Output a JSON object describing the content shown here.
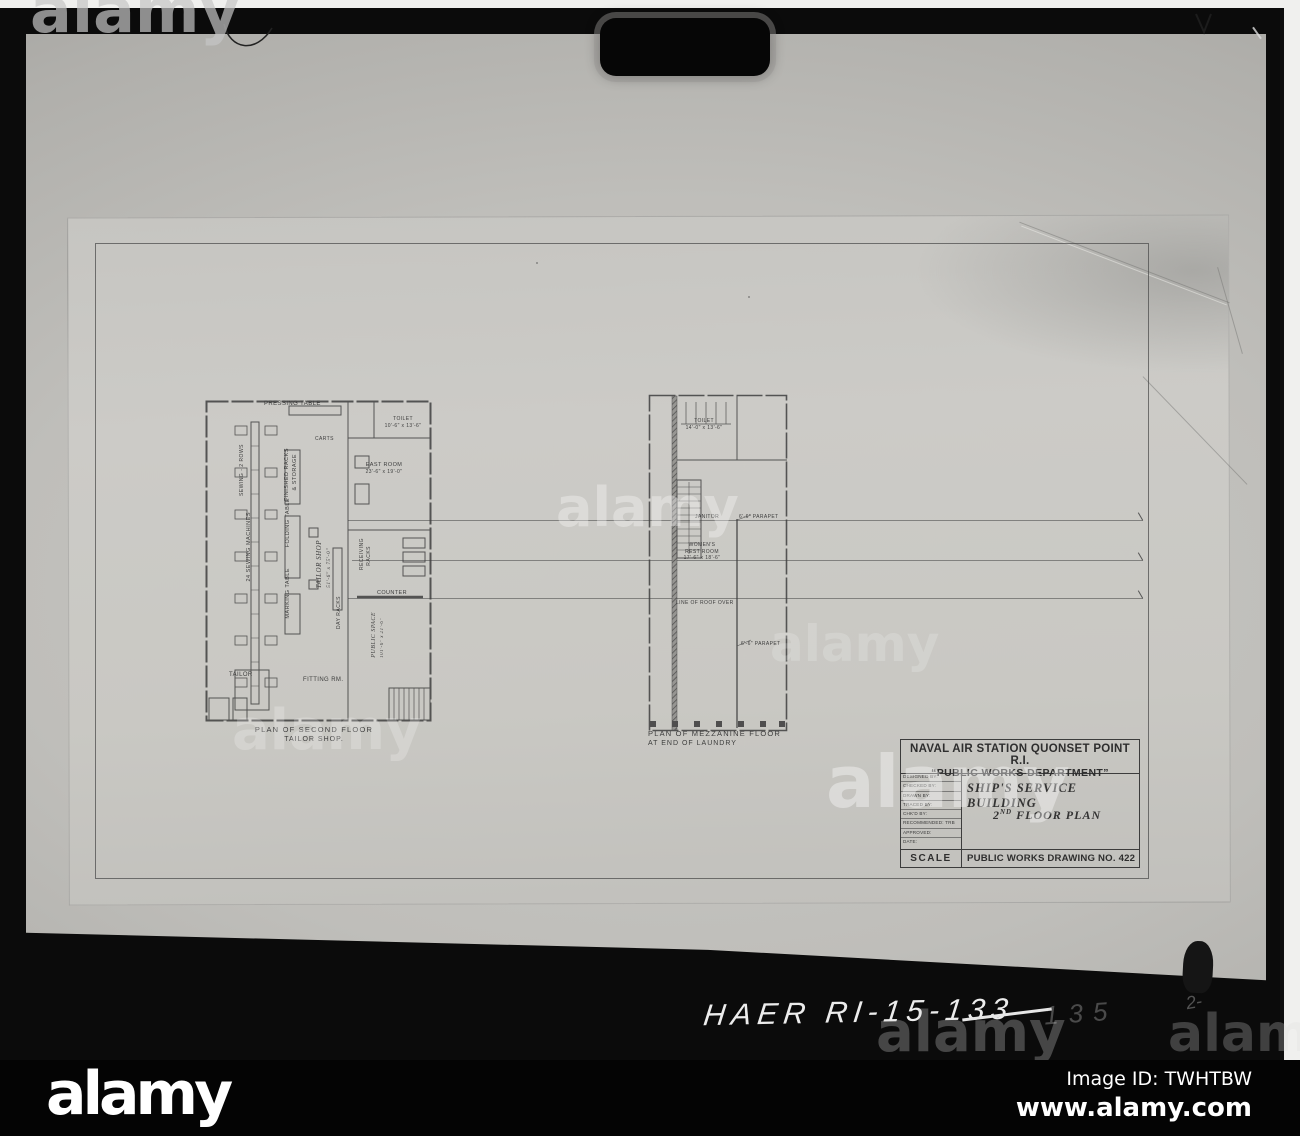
{
  "photo": {
    "backdrop_color": "#b6b5b1",
    "sheet_color": "#c9c8c4",
    "handwriting": {
      "prefix": "HAER RI-15-",
      "struck_number": "133",
      "faint_correction": "135",
      "corner_scribble": "2-"
    }
  },
  "watermark": {
    "text": "alamy"
  },
  "drawing": {
    "left_plan": {
      "caption_line1": "PLAN OF SECOND FLOOR",
      "caption_line2": "TAILOR SHOP.",
      "labels": {
        "pressing_table": "PRESSING TABLE",
        "toilet": "TOILET",
        "toilet_dims": "10'-6\" x 13'-6\"",
        "carts": "CARTS",
        "finished_racks_1": "FINISHED RACKS",
        "finished_racks_2": "& STORAGE",
        "east_room": "EAST ROOM",
        "east_room_dims": "23'-6\" x 19'-0\"",
        "sewing_rows": "SEWING - 2 ROWS",
        "sewing_machines": "24 SEWING MACHINES",
        "folding_table": "FOLDING TABLE",
        "marking_table": "MARKING TABLE",
        "tailor_shop": "TAILOR SHOP",
        "tailor_shop_dims": "51'-6\" x 75'-0\"",
        "receiving_racks_1": "RECEIVING",
        "receiving_racks_2": "RACKS",
        "day_racks": "DAY RACKS",
        "counter": "COUNTER",
        "public_space": "PUBLIC SPACE",
        "public_space_dims": "101'-6\" x 21'-6\"",
        "tailor": "TAILOR",
        "fitting_room": "FITTING RM."
      }
    },
    "center_plan": {
      "caption_line1": "PLAN OF MEZZANINE FLOOR",
      "caption_line2": "AT END OF LAUNDRY",
      "labels": {
        "toilet": "TOILET",
        "toilet_dims": "14'-0\" x 13'-6\"",
        "janitor": "JANITOR",
        "parapet_upper": "6'-6\" PARAPET",
        "womens_1": "WOMEN'S",
        "womens_2": "REST ROOM",
        "womens_dims": "17'-6\" x 18'-6\"",
        "roof_line": "LINE OF ROOF OVER",
        "parapet_lower": "6'-6\" PARAPET"
      }
    },
    "title_block": {
      "agency_line1": "NAVAL AIR STATION QUONSET POINT R.I.",
      "agency_line2": "“PUBLIC WORKS DEPARTMENT”",
      "rows": {
        "r1": "DESIGNED BY:",
        "r2": "CHECKED BY:",
        "r3": "DRAWN BY:",
        "r4": "TRACED BY:",
        "r5": "CHK'D BY:",
        "r6": "RECOMMENDED:",
        "r6_value": "TRB",
        "r7": "APPROVED:",
        "r8": "DATE:"
      },
      "building": "SHIP'S SERVICE BUILDING",
      "plan_number": "2",
      "plan_ordinal": "ND",
      "plan_text": " FLOOR PLAN",
      "scale_label": "SCALE",
      "drawing_number": "PUBLIC WORKS DRAWING NO. 422"
    }
  },
  "footer": {
    "logo": "alamy",
    "image_id": "Image ID: TWHTBW",
    "website": "www.alamy.com"
  }
}
